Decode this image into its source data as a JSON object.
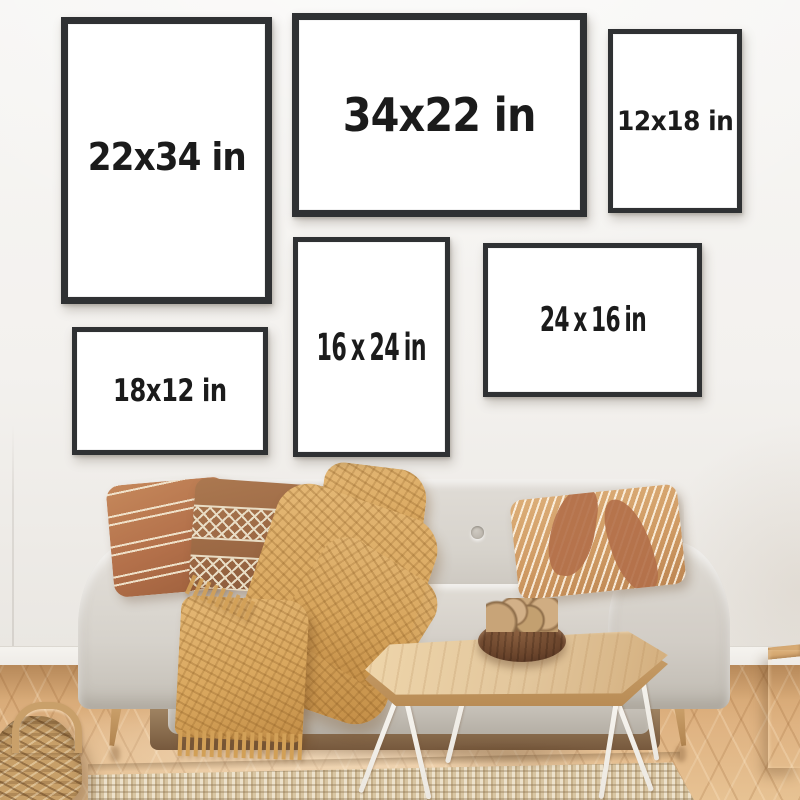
{
  "frames": [
    {
      "name": "frame-22x34",
      "label": "22x34 in",
      "orientation": "portrait"
    },
    {
      "name": "frame-34x22",
      "label": "34x22 in",
      "orientation": "landscape"
    },
    {
      "name": "frame-12x18",
      "label": "12x18 in",
      "orientation": "portrait"
    },
    {
      "name": "frame-16x24",
      "label": "16 x 24 in",
      "orientation": "portrait"
    },
    {
      "name": "frame-24x16",
      "label": "24 x 16 in",
      "orientation": "landscape"
    },
    {
      "name": "frame-18x12",
      "label": "18x12 in",
      "orientation": "landscape"
    }
  ],
  "colors": {
    "wall": "#f3f1ee",
    "frame_border": "#2f3133",
    "frame_face": "#ffffff",
    "label_text": "#1b1b1b",
    "sofa_fabric": "#d7d3cc",
    "pillow_rust": "#b3704a",
    "pillow_brown": "#9a6743",
    "pillow_tan": "#cf9a63",
    "pillow_stripe": "#eee2cb",
    "blanket": "#d9a75e",
    "table_wood": "#e2c69c",
    "table_leg": "#ece8e1",
    "bowl": "#6b452c",
    "nuts": "#c8a478",
    "floor_wood": "#dfb382",
    "rug": "#d8c5a2",
    "basket": "#c79f68",
    "stool_wood": "#bd8a52",
    "baseboard": "#eeebe6"
  }
}
